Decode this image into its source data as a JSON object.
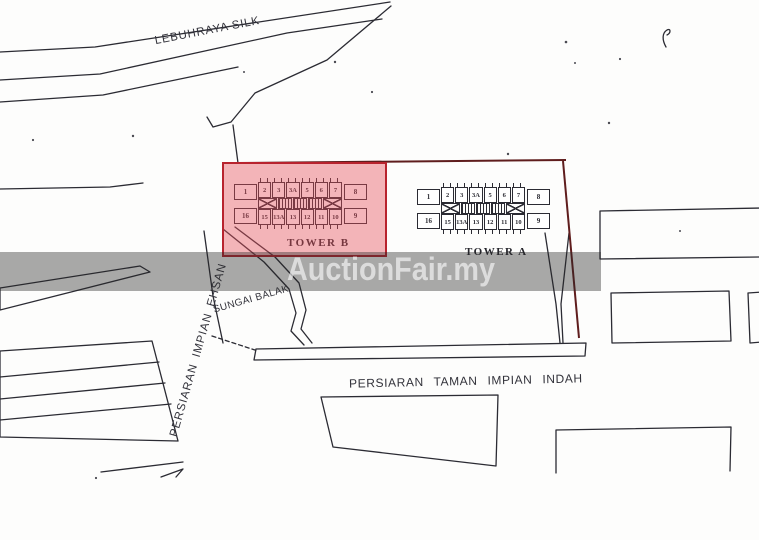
{
  "document": {
    "type_label": "site plan",
    "background_color": "#fdfdfc",
    "line_color": "#2b2b33",
    "boundary_color": "#5f1d1d"
  },
  "watermark": {
    "text": "AuctionFair.my",
    "band_color": "rgba(40,40,40,0.40)",
    "text_color": "rgba(255,255,255,0.60)"
  },
  "highlight": {
    "fill_color": "rgba(228,78,90,0.42)",
    "border_color": "#b8232e"
  },
  "roads": {
    "lebuhraya_silk": "LEBUHRAYA SILK",
    "persiaran_impian_ehsan": "PERSIARAN IMPIAN EHSAN",
    "persiaran_taman_impian_indah": "PERSIARAN TAMAN IMPIAN INDAH",
    "sungai_balak": "SUNGAI BALAK"
  },
  "towers": {
    "tower_b": {
      "label": "TOWER B",
      "highlighted": true,
      "units_top": [
        "2",
        "3",
        "3A",
        "5",
        "6",
        "7"
      ],
      "units_bottom": [
        "15",
        "13A",
        "13",
        "12",
        "11",
        "10"
      ],
      "units_left": [
        "1",
        "16"
      ],
      "units_right": [
        "8",
        "9"
      ]
    },
    "tower_a": {
      "label": "TOWER A",
      "highlighted": false,
      "units_top": [
        "2",
        "3",
        "3A",
        "5",
        "6",
        "7"
      ],
      "units_bottom": [
        "15",
        "13A",
        "13",
        "12",
        "11",
        "10"
      ],
      "units_left": [
        "1",
        "16"
      ],
      "units_right": [
        "8",
        "9"
      ]
    }
  }
}
